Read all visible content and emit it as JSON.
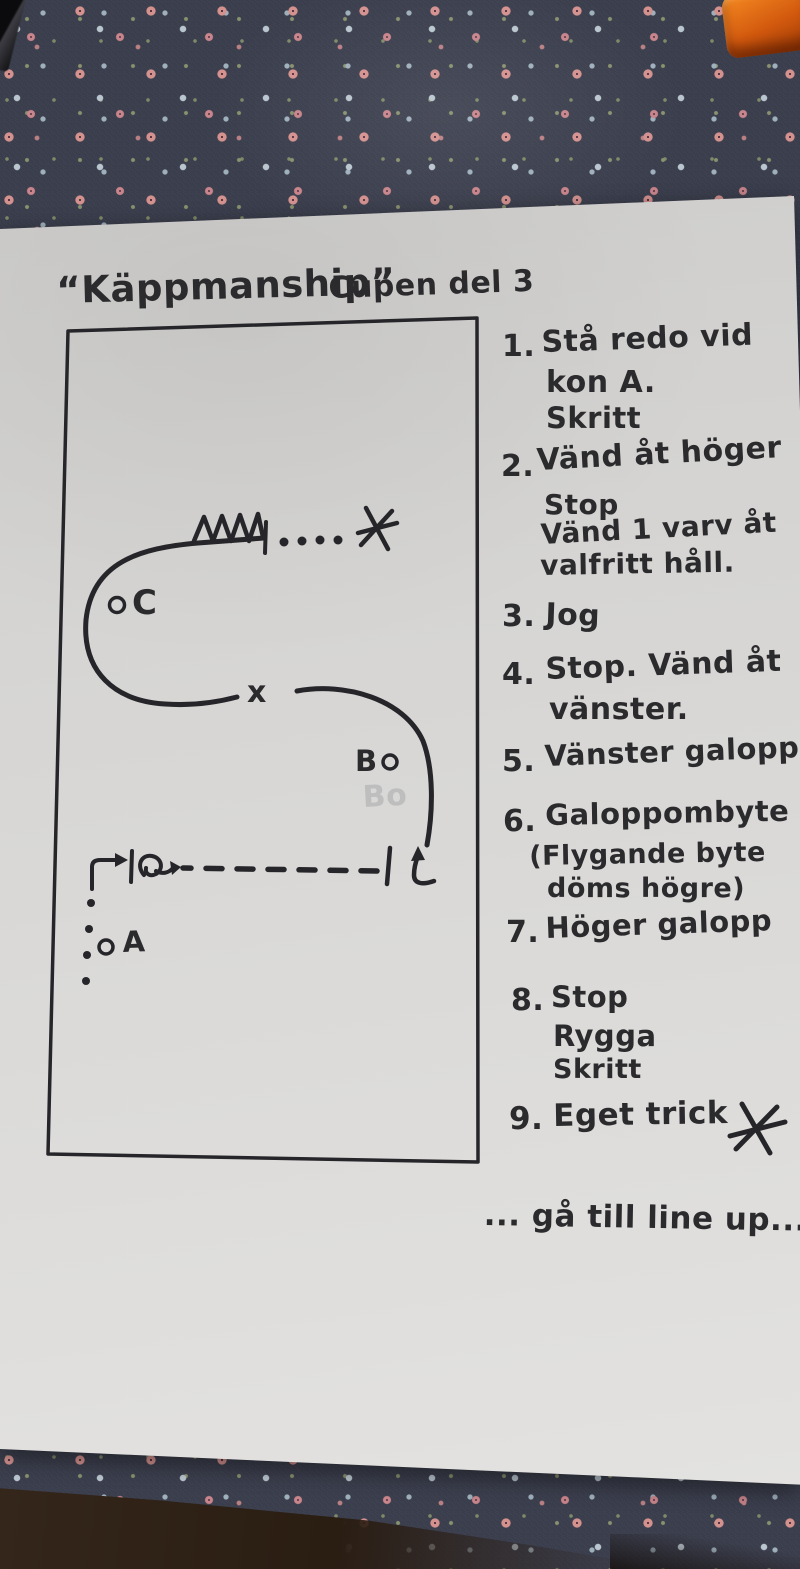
{
  "colors": {
    "ink": "#2b2b2e",
    "paper": "#d8d7d5",
    "fabric": "#3a3d4c",
    "orange": "#d2590e"
  },
  "title": {
    "main": "“Käppmanship”",
    "sub": "Cupen del 3"
  },
  "arena": {
    "marker_c": "C",
    "marker_b": "B",
    "marker_a": "A",
    "marker_x": "x",
    "ghost_pencil": "Bo"
  },
  "instructions": [
    {
      "num": "1.",
      "lines": [
        "Stå redo vid",
        "kon A.",
        "Skritt"
      ]
    },
    {
      "num": "2.",
      "lines": [
        "Vänd åt höger",
        "Stop",
        "Vänd 1 varv åt",
        "valfritt håll."
      ]
    },
    {
      "num": "3.",
      "lines": [
        "Jog"
      ]
    },
    {
      "num": "4.",
      "lines": [
        "Stop. Vänd åt",
        "vänster."
      ]
    },
    {
      "num": "5.",
      "lines": [
        "Vänster galopp"
      ]
    },
    {
      "num": "6.",
      "lines": [
        "Galoppombyte",
        "(Flygande byte",
        "döms högre)"
      ]
    },
    {
      "num": "7.",
      "lines": [
        "Höger galopp"
      ]
    },
    {
      "num": "8.",
      "lines": [
        "Stop",
        "Rygga",
        "Skritt"
      ]
    },
    {
      "num": "9.",
      "lines": [
        "Eget trick"
      ]
    }
  ],
  "footer": "... gå till line up..."
}
